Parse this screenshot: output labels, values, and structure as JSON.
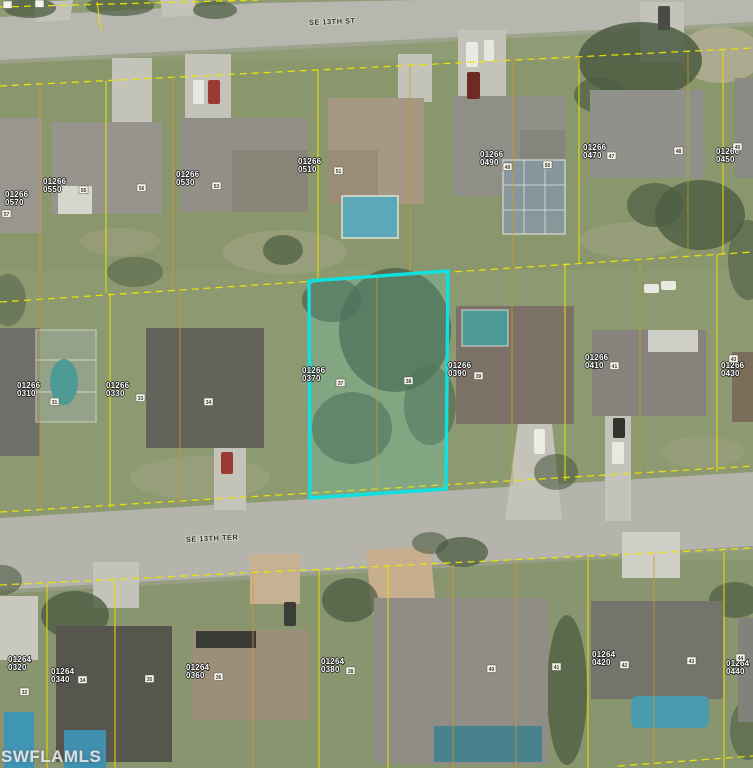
{
  "map": {
    "streets": [
      {
        "name": "SE 13TH ST"
      },
      {
        "name": "SE 13TH TER"
      }
    ],
    "watermark": {
      "text": "SWFLAMLS"
    },
    "colors": {
      "parcel_line": "#e8e000",
      "parcel_line_alt": "#cf9a26",
      "highlight": "#0fe0e0",
      "label_text": "#ffffff"
    },
    "highlighted_parcel": {
      "id": "01266 0370",
      "platted_lots": [
        "37",
        "38"
      ]
    },
    "parcel_labels": [
      {
        "block": "01266",
        "lot": "0570",
        "x": 5,
        "y": 197
      },
      {
        "block": "01266",
        "lot": "0550",
        "x": 43,
        "y": 184
      },
      {
        "block": "01266",
        "lot": "0530",
        "x": 176,
        "y": 177
      },
      {
        "block": "01266",
        "lot": "0510",
        "x": 298,
        "y": 164
      },
      {
        "block": "01266",
        "lot": "0490",
        "x": 480,
        "y": 157
      },
      {
        "block": "01266",
        "lot": "0470",
        "x": 583,
        "y": 150
      },
      {
        "block": "01266",
        "lot": "0450",
        "x": 716,
        "y": 154
      },
      {
        "block": "01266",
        "lot": "0310",
        "x": 17,
        "y": 388
      },
      {
        "block": "01266",
        "lot": "0330",
        "x": 106,
        "y": 388
      },
      {
        "block": "01266",
        "lot": "0370",
        "x": 302,
        "y": 373
      },
      {
        "block": "01266",
        "lot": "0390",
        "x": 448,
        "y": 368
      },
      {
        "block": "01266",
        "lot": "0410",
        "x": 585,
        "y": 360
      },
      {
        "block": "01266",
        "lot": "0430",
        "x": 721,
        "y": 368
      },
      {
        "block": "01264",
        "lot": "0320",
        "x": 8,
        "y": 662
      },
      {
        "block": "01264",
        "lot": "0340",
        "x": 51,
        "y": 674
      },
      {
        "block": "01264",
        "lot": "0360",
        "x": 186,
        "y": 670
      },
      {
        "block": "01264",
        "lot": "0380",
        "x": 321,
        "y": 664
      },
      {
        "block": "01264",
        "lot": "0420",
        "x": 592,
        "y": 657
      },
      {
        "block": "01264",
        "lot": "0440",
        "x": 726,
        "y": 666
      }
    ],
    "lot_markers": [
      {
        "n": "",
        "x": 3,
        "y": 1
      },
      {
        "n": "",
        "x": 35,
        "y": 0
      },
      {
        "n": "57",
        "x": 2,
        "y": 210
      },
      {
        "n": "55",
        "x": 79,
        "y": 186
      },
      {
        "n": "56",
        "x": 137,
        "y": 184
      },
      {
        "n": "53",
        "x": 212,
        "y": 182
      },
      {
        "n": "51",
        "x": 334,
        "y": 167
      },
      {
        "n": "49",
        "x": 503,
        "y": 163
      },
      {
        "n": "50",
        "x": 543,
        "y": 161
      },
      {
        "n": "47",
        "x": 607,
        "y": 152
      },
      {
        "n": "48",
        "x": 674,
        "y": 147
      },
      {
        "n": "45",
        "x": 733,
        "y": 143
      },
      {
        "n": "31",
        "x": 50,
        "y": 398
      },
      {
        "n": "33",
        "x": 136,
        "y": 394
      },
      {
        "n": "34",
        "x": 204,
        "y": 398
      },
      {
        "n": "37",
        "x": 336,
        "y": 379
      },
      {
        "n": "38",
        "x": 404,
        "y": 377
      },
      {
        "n": "39",
        "x": 474,
        "y": 372
      },
      {
        "n": "41",
        "x": 610,
        "y": 362
      },
      {
        "n": "43",
        "x": 729,
        "y": 355
      },
      {
        "n": "32",
        "x": 20,
        "y": 688
      },
      {
        "n": "34",
        "x": 78,
        "y": 676
      },
      {
        "n": "35",
        "x": 145,
        "y": 675
      },
      {
        "n": "36",
        "x": 214,
        "y": 673
      },
      {
        "n": "38",
        "x": 346,
        "y": 667
      },
      {
        "n": "40",
        "x": 487,
        "y": 665
      },
      {
        "n": "41",
        "x": 552,
        "y": 663
      },
      {
        "n": "42",
        "x": 620,
        "y": 661
      },
      {
        "n": "43",
        "x": 687,
        "y": 657
      },
      {
        "n": "44",
        "x": 736,
        "y": 654
      }
    ]
  }
}
